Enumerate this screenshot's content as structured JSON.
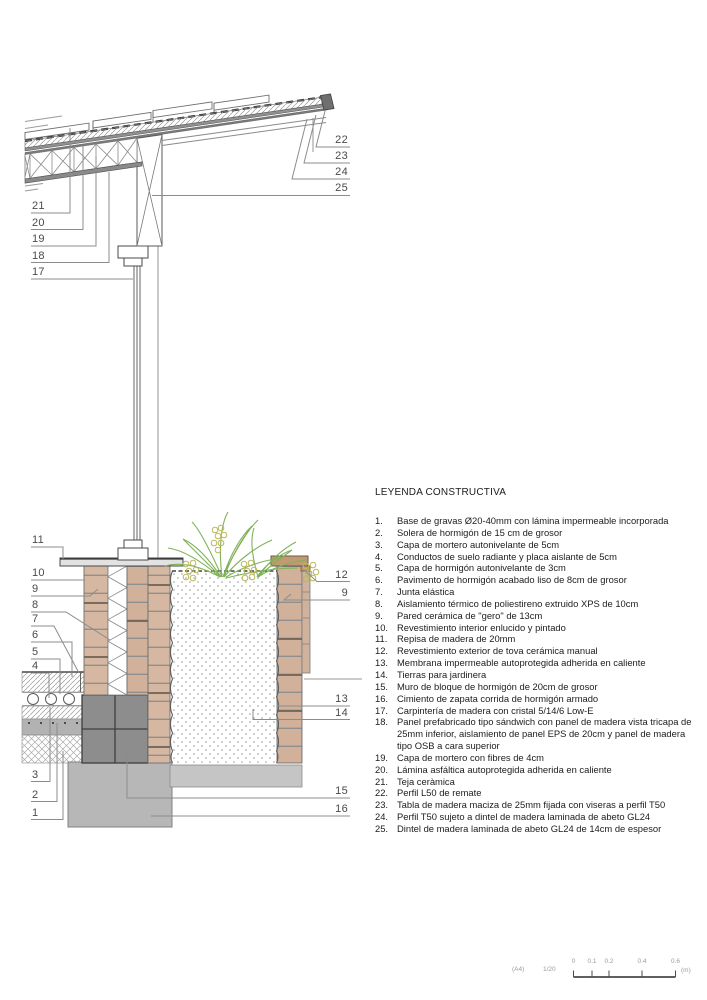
{
  "legend": {
    "title": "LEYENDA CONSTRUCTIVA",
    "items": [
      {
        "num": "1.",
        "text": "Base de gravas Ø20-40mm con lámina impermeable incorporada"
      },
      {
        "num": "2.",
        "text": "Solera de hormigón de 15 cm de grosor"
      },
      {
        "num": "3.",
        "text": "Capa de mortero autonivelante de 5cm"
      },
      {
        "num": "4.",
        "text": "Conductos de suelo radiante y placa aislante de 5cm"
      },
      {
        "num": "5.",
        "text": "Capa de hormigón autonivelante de 3cm"
      },
      {
        "num": "6.",
        "text": "Pavimento de hormigón acabado liso de 8cm de grosor"
      },
      {
        "num": "7.",
        "text": "Junta elástica"
      },
      {
        "num": "8.",
        "text": "Aislamiento térmico de poliestireno extruido XPS de 10cm"
      },
      {
        "num": "9.",
        "text": "Pared cerámica de \"gero\" de 13cm"
      },
      {
        "num": "10.",
        "text": "Revestimiento interior enlucido y pintado"
      },
      {
        "num": "11.",
        "text": "Repisa de madera de 20mm"
      },
      {
        "num": "12.",
        "text": "Revestimiento exterior de tova cerámica manual"
      },
      {
        "num": "13.",
        "text": "Membrana impermeable autoprotegida adherida en caliente"
      },
      {
        "num": "14.",
        "text": "Tierras para jardinera"
      },
      {
        "num": "15.",
        "text": "Muro de bloque de hormigón de 20cm de grosor"
      },
      {
        "num": "16.",
        "text": "Cimiento de zapata corrida de hormigón armado"
      },
      {
        "num": "17.",
        "text": "Carpintería  de madera con cristal 5/14/6 Low-E"
      },
      {
        "num": "18.",
        "text": "Panel prefabricado tipo sándwich con panel de madera vista tricapa de 25mm inferior, aislamiento de panel EPS de 20cm y panel de madera tipo OSB a cara superior"
      },
      {
        "num": "19.",
        "text": "Capa de mortero con fibres de 4cm"
      },
      {
        "num": "20.",
        "text": "Lámina asfáltica autoprotegida adherida en caliente"
      },
      {
        "num": "21.",
        "text": "Teja ceràmica"
      },
      {
        "num": "22.",
        "text": "Perfil L50 de remate"
      },
      {
        "num": "23.",
        "text": "Tabla de madera maciza de 25mm fijada con viseras a perfil T50"
      },
      {
        "num": "24.",
        "text": "Perfil T50 sujeto a dintel de madera laminada de abeto GL24"
      },
      {
        "num": "25.",
        "text": "Dintel de madera laminada de abeto GL24 de 14cm de espesor"
      }
    ]
  },
  "drawing": {
    "callouts": [
      {
        "id": "c21",
        "label": "21"
      },
      {
        "id": "c20",
        "label": "20"
      },
      {
        "id": "c19",
        "label": "19"
      },
      {
        "id": "c18",
        "label": "18"
      },
      {
        "id": "c17",
        "label": "17"
      },
      {
        "id": "c22",
        "label": "22"
      },
      {
        "id": "c23",
        "label": "23"
      },
      {
        "id": "c24",
        "label": "24"
      },
      {
        "id": "c25",
        "label": "25"
      },
      {
        "id": "c11",
        "label": "11"
      },
      {
        "id": "c10",
        "label": "10"
      },
      {
        "id": "c9L",
        "label": "9"
      },
      {
        "id": "c8",
        "label": "8"
      },
      {
        "id": "c7",
        "label": "7"
      },
      {
        "id": "c6",
        "label": "6"
      },
      {
        "id": "c5",
        "label": "5"
      },
      {
        "id": "c4",
        "label": "4"
      },
      {
        "id": "c3",
        "label": "3"
      },
      {
        "id": "c2",
        "label": "2"
      },
      {
        "id": "c1",
        "label": "1"
      },
      {
        "id": "c12",
        "label": "12"
      },
      {
        "id": "c9R",
        "label": "9"
      },
      {
        "id": "c13",
        "label": "13"
      },
      {
        "id": "c14",
        "label": "14"
      },
      {
        "id": "c15",
        "label": "15"
      },
      {
        "id": "c16",
        "label": "16"
      }
    ],
    "colors": {
      "brick": "#d6b8a2",
      "brick_alt": "#d2b19a",
      "block": "#8d8d8d",
      "foundation": "#b7b7b7",
      "slab": "#c5c5c5",
      "wood_cap": "#c09a72",
      "plant_green": "#7fb258",
      "berry": "#bcb75b",
      "linework": "#5a5a5a",
      "leader": "#8c8c8c",
      "label_text": "#4a4a4a"
    }
  },
  "scalebar": {
    "sheet": "(A4)",
    "scale": "1/20",
    "ticks": [
      "0",
      "0.1",
      "0.2",
      "0.4",
      "0.6"
    ],
    "unit": "(m)"
  }
}
